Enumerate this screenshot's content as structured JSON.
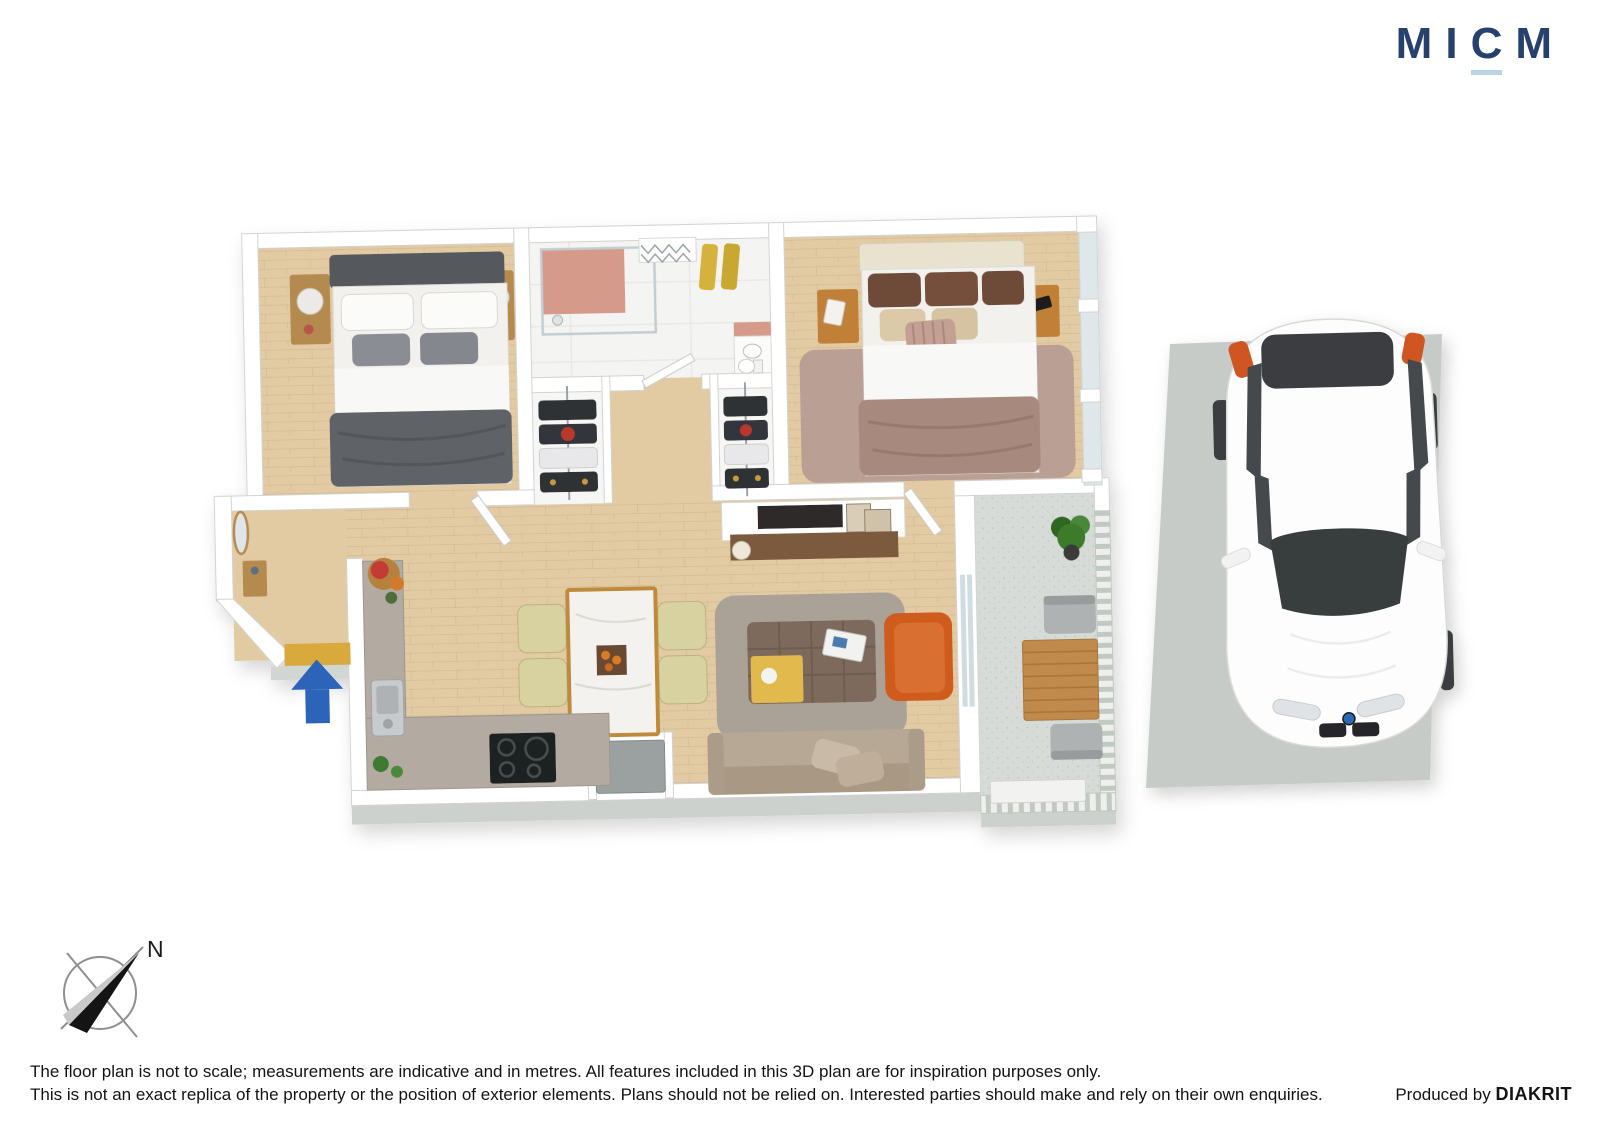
{
  "brand": {
    "logo_letters": [
      "M",
      "I",
      "C",
      "M"
    ],
    "logo_color": "#27416d",
    "logo_underline_color": "#b9d3e9"
  },
  "compass": {
    "north_label": "N"
  },
  "disclaimer": {
    "line1": "The floor plan is not to scale; measurements are indicative and in metres. All features included in this 3D plan are for inspiration purposes only.",
    "line2": "This is not an exact replica of the property or the position of exterior elements. Plans should not be relied on. Interested parties should make and rely on their own enquiries."
  },
  "credit": {
    "prefix": "Produced by ",
    "producer": "DIAKRIT"
  },
  "floor_plan": {
    "type": "3d-floor-plan-top-view",
    "entry_arrow_color": "#2b64b8",
    "rooms": [
      "entry",
      "bedroom-1",
      "bathroom",
      "wardrobe-1",
      "wardrobe-2",
      "bedroom-2",
      "kitchen",
      "dining-area",
      "living-area",
      "balcony"
    ],
    "colors": {
      "wall": "#ffffff",
      "wood_floor": "#e2cba3",
      "bathroom_floor": "#f4f4f2",
      "balcony_floor": "#d7dbd7",
      "concrete": "#cdd1cd"
    }
  },
  "parking": {
    "vehicle": "white-car-top-view",
    "pad_color": "#c7cbc7"
  }
}
